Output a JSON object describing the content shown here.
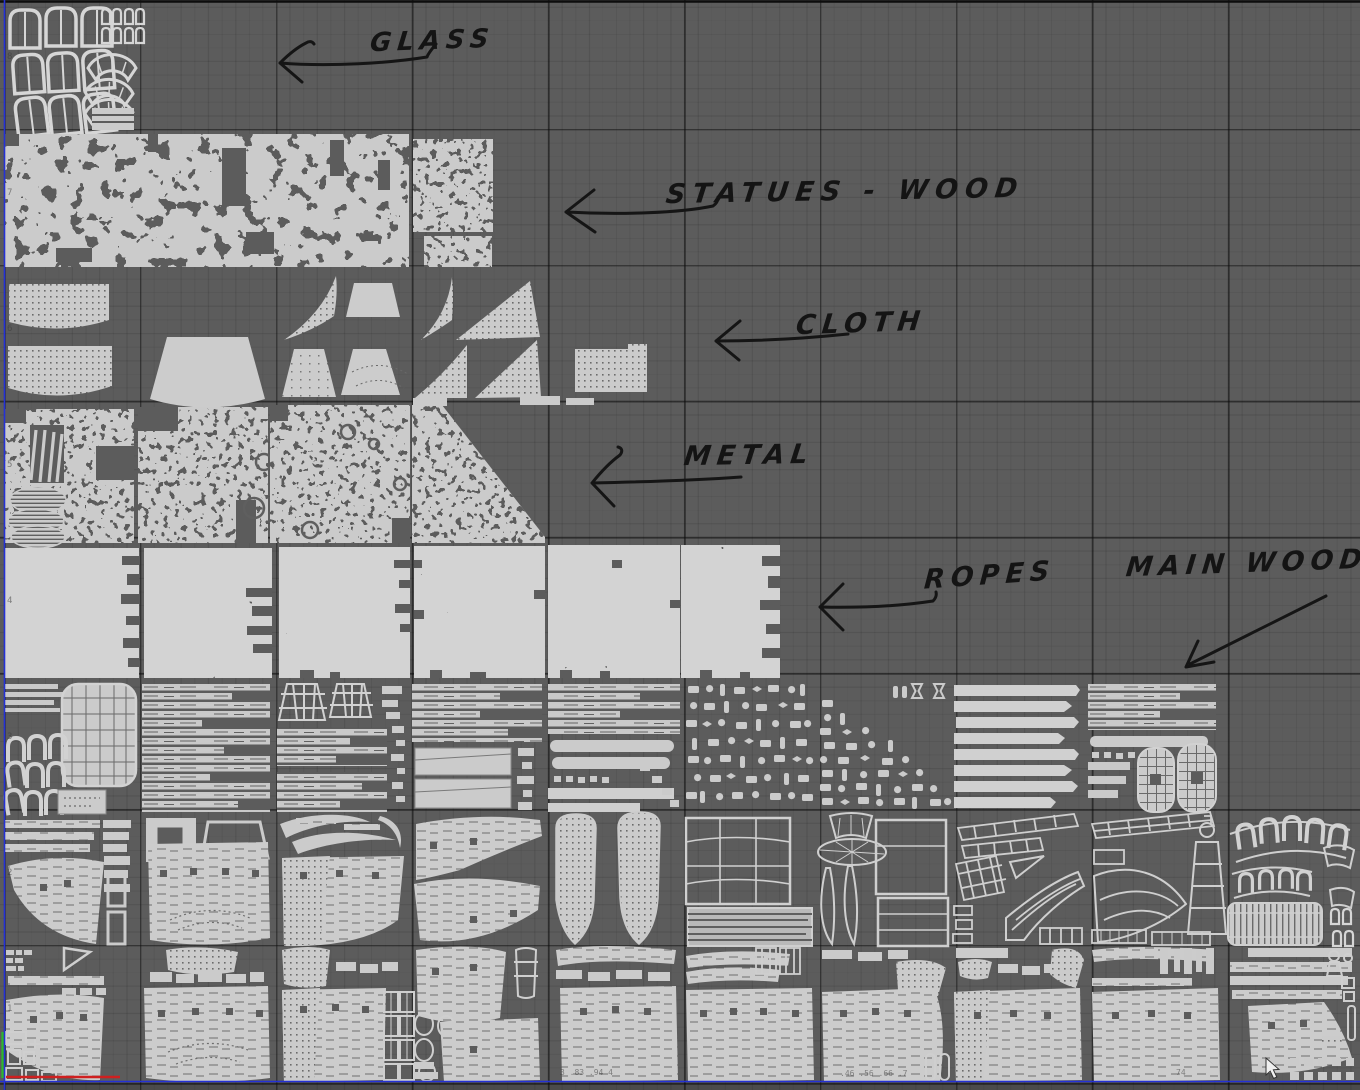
{
  "annotations": {
    "glass": {
      "label": "GLASS"
    },
    "statues_wood": {
      "label": "STATUES - WOOD"
    },
    "cloth": {
      "label": "CLOTH"
    },
    "metal": {
      "label": "METAL"
    },
    "ropes": {
      "label": "ROPES"
    },
    "main_wood": {
      "label": "MAIN WOOD"
    }
  },
  "ruler": {
    "left": [
      "8",
      "7",
      "6",
      "5",
      "4",
      "3",
      "2",
      "1"
    ],
    "bottom": [
      "3 .83 .94 4",
      ".46 .56 .66 .7",
      "74"
    ]
  },
  "colors": {
    "viewport_background": "#5c5c5c",
    "grid_major": "#1a1a1a",
    "grid_minor": "#515151",
    "island_fill": "#cbcbcb",
    "island_bright": "#d3d3d3",
    "texture_detail": "#6a6a6a",
    "annotation_ink": "#141414",
    "uv_boundary_blue": "#2431d6",
    "axis_red": "#cf1f1f",
    "axis_green": "#2db82d",
    "cursor_white": "#efefef"
  }
}
